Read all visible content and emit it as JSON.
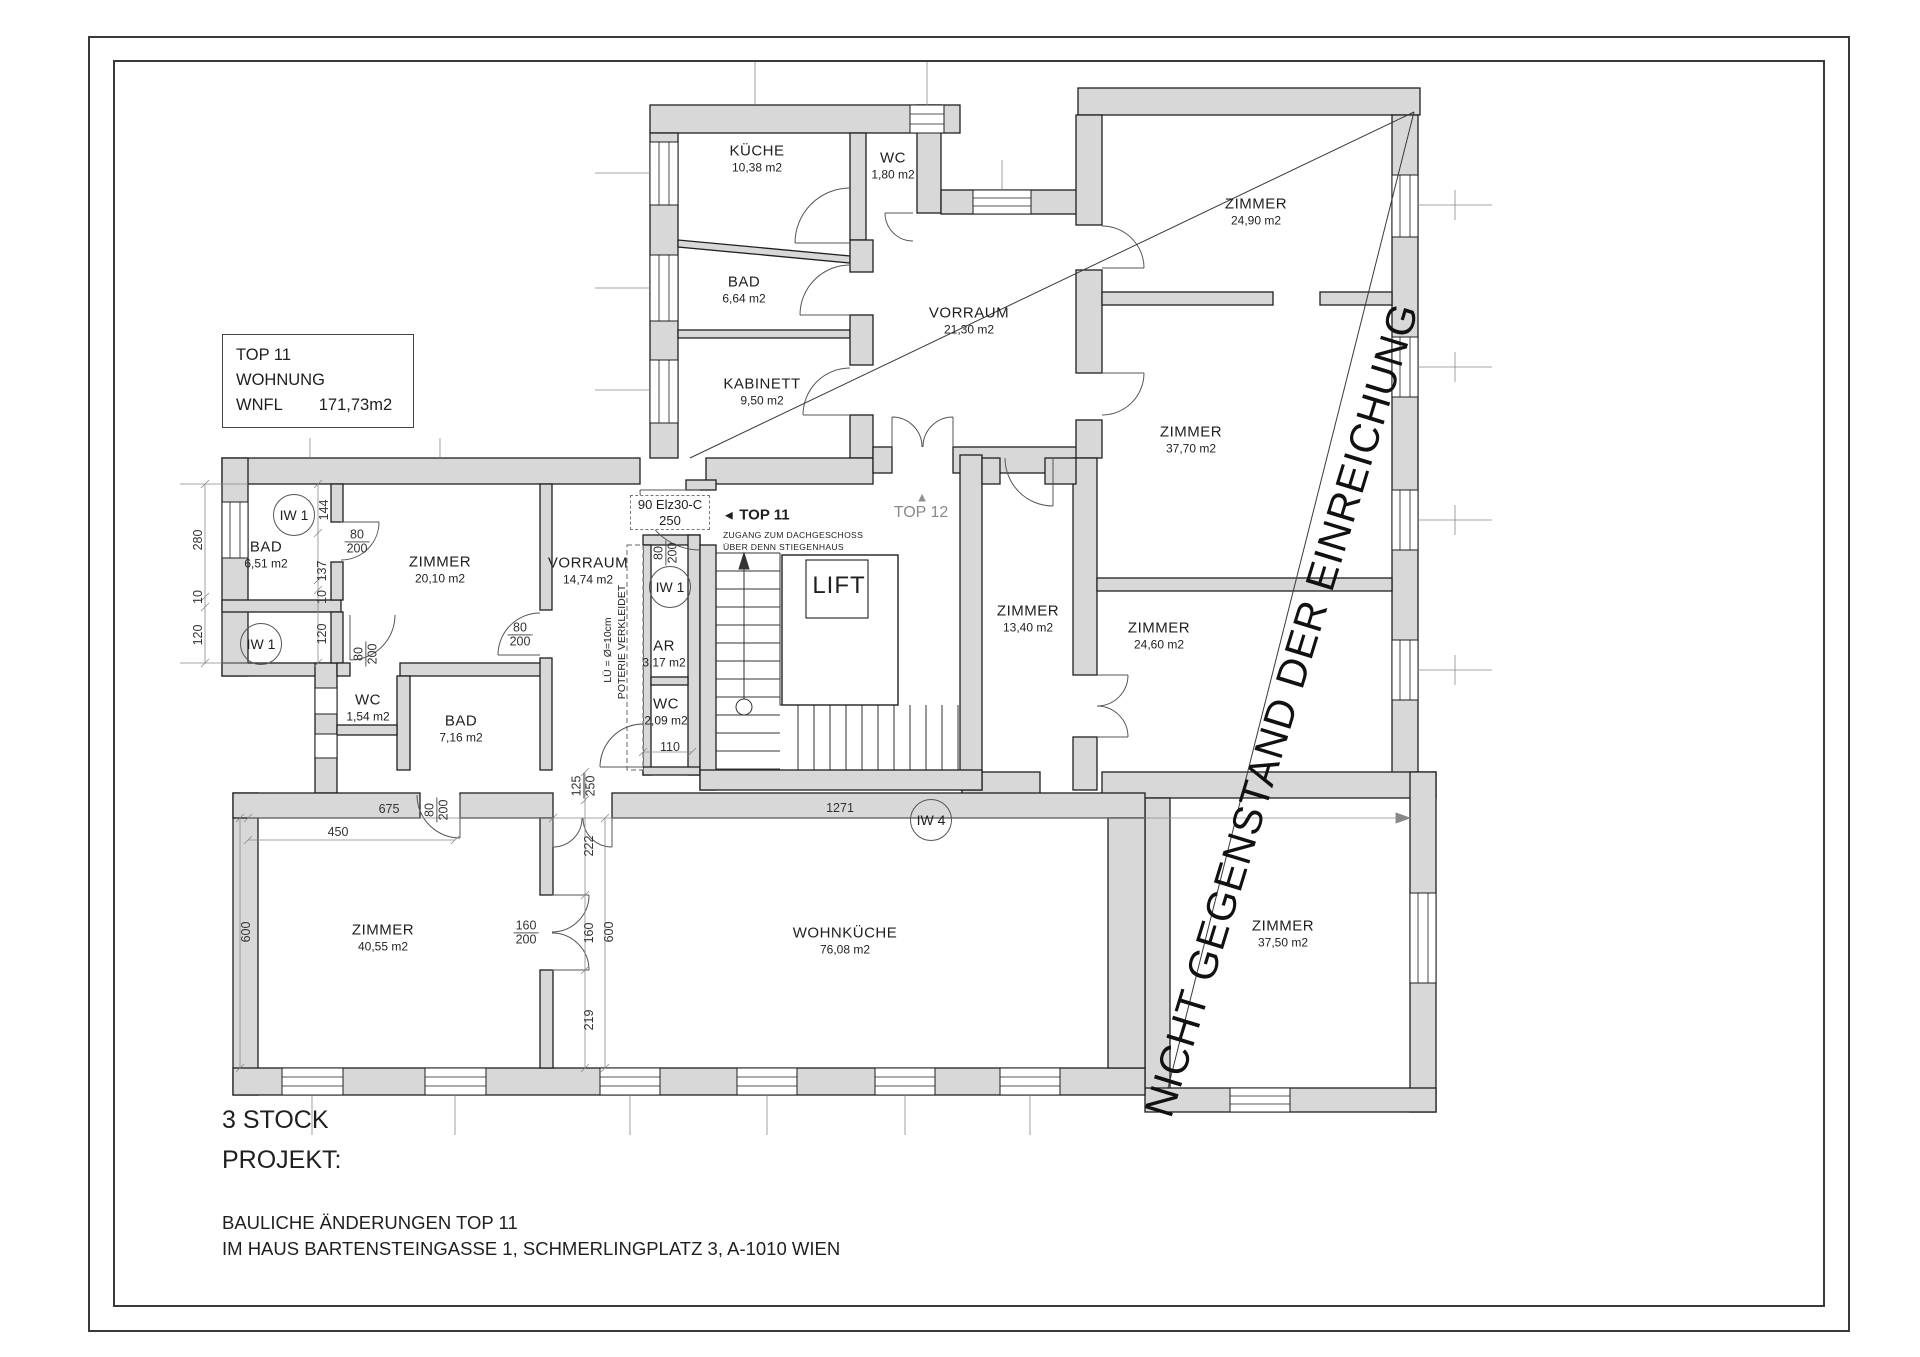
{
  "colors": {
    "wall_fill": "#d8d8d8",
    "line": "#1f1f1f",
    "dim_line": "#777777"
  },
  "title_box": {
    "top": "TOP 11",
    "type": "WOHNUNG",
    "wnfl_label": "WNFL",
    "wnfl_value": "171,73m2"
  },
  "rooms": [
    {
      "name": "KÜCHE",
      "area": "10,38 m2"
    },
    {
      "name": "WC",
      "area": "1,80 m2"
    },
    {
      "name": "BAD",
      "area": "6,64 m2"
    },
    {
      "name": "KABINETT",
      "area": "9,50 m2"
    },
    {
      "name": "VORRAUM",
      "area": "21,30 m2"
    },
    {
      "name": "ZIMMER",
      "area": "24,90 m2"
    },
    {
      "name": "ZIMMER",
      "area": "37,70 m2"
    },
    {
      "name": "ZIMMER",
      "area": "13,40 m2"
    },
    {
      "name": "ZIMMER",
      "area": "24,60 m2"
    },
    {
      "name": "ZIMMER",
      "area": "37,50 m2"
    },
    {
      "name": "BAD",
      "area": "6,51 m2"
    },
    {
      "name": "ZIMMER",
      "area": "20,10 m2"
    },
    {
      "name": "VORRAUM",
      "area": "14,74 m2"
    },
    {
      "name": "AR",
      "area": "3,17 m2"
    },
    {
      "name": "WC",
      "area": "2,09 m2"
    },
    {
      "name": "WC",
      "area": "1,54 m2"
    },
    {
      "name": "BAD",
      "area": "7,16 m2"
    },
    {
      "name": "ZIMMER",
      "area": "40,55 m2"
    },
    {
      "name": "WOHNKÜCHE",
      "area": "76,08 m2"
    },
    {
      "name": "LIFT",
      "area": ""
    }
  ],
  "annotations": {
    "door_spec_line1": "90 Elz30-C",
    "door_spec_line2": "250",
    "entry_label": "TOP 11",
    "zugang_line1": "ZUGANG ZUM DACHGESCHOSS",
    "zugang_line2": "ÜBER DENN STIEGENHAUS",
    "top12_label": "TOP 12",
    "iw1": "IW 1",
    "iw4": "IW 4",
    "shaft_line1": "LÜ = Ø=10cm",
    "shaft_line2": "POTERIE VERKLEIDET",
    "disclaimer": "NICHT GEGENSTAND DER EINREICHUNG"
  },
  "icons": {
    "arrow_left": "◄",
    "arrow_up": "▲"
  },
  "dims": {
    "v280": "280",
    "v10": "10",
    "v120": "120",
    "v144": "144",
    "v137": "137",
    "v80": "80",
    "v200": "200",
    "v250": "250",
    "v110": "110",
    "v675": "675",
    "v450": "450",
    "v600": "600",
    "v160": "160",
    "v222": "222",
    "v219": "219",
    "v125": "125",
    "v1271": "1271"
  },
  "footer": {
    "floor": "3 STOCK",
    "project_label": "PROJEKT:",
    "project_line1": "BAULICHE ÄNDERUNGEN TOP 11",
    "project_line2": "IM HAUS BARTENSTEINGASSE 1, SCHMERLINGPLATZ 3, A-1010 WIEN"
  }
}
